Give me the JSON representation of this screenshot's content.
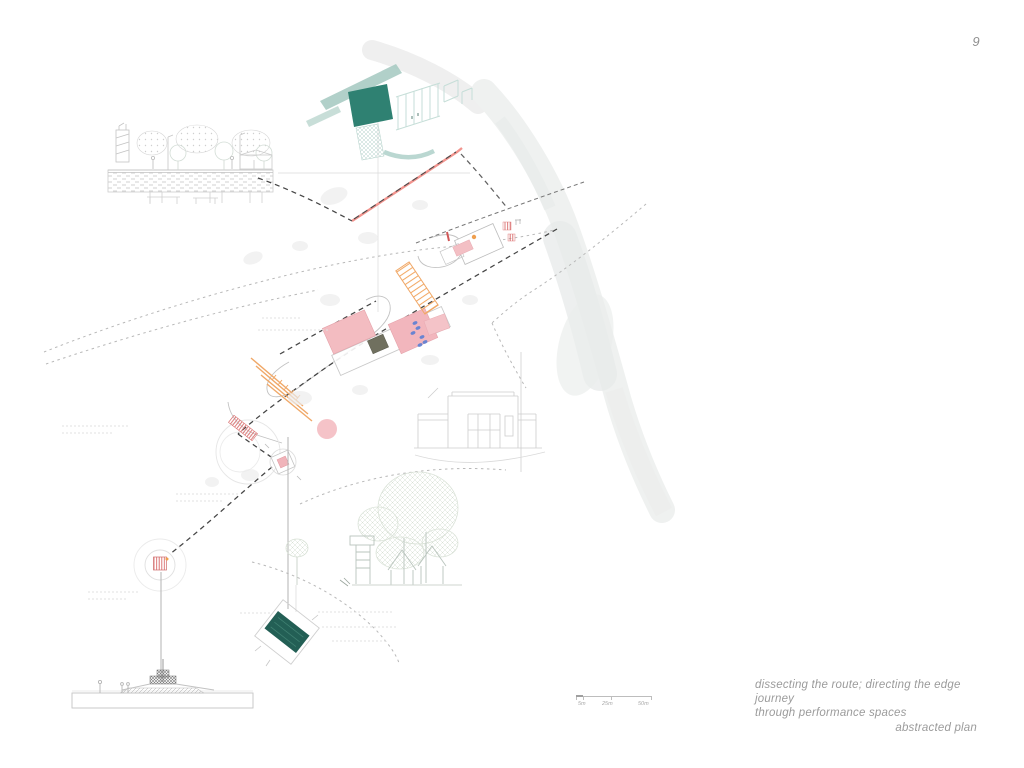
{
  "page": {
    "number": "9"
  },
  "caption": {
    "line1": "dissecting the route; directing the edge journey",
    "line2": "through performance spaces",
    "title": "abstracted plan"
  },
  "scale_bar": {
    "labels": [
      "5m",
      "25m",
      "50m"
    ]
  },
  "drawing": {
    "colors": {
      "teal_pavilion": "#2f8172",
      "teal_boat": "#235f55",
      "teal_light_band": "#a3c8c0",
      "pink_building": "#f3bcc1",
      "salmon_edge_line": "#f2948e",
      "orange_stair": "#f2a965",
      "blue_marks": "#5b7fd4",
      "red_hatch_marker": "#d96a6a",
      "route_dash": "#454545",
      "sketch_gray": "#c9c9c9",
      "coastal_band": "#eff1f0"
    }
  }
}
